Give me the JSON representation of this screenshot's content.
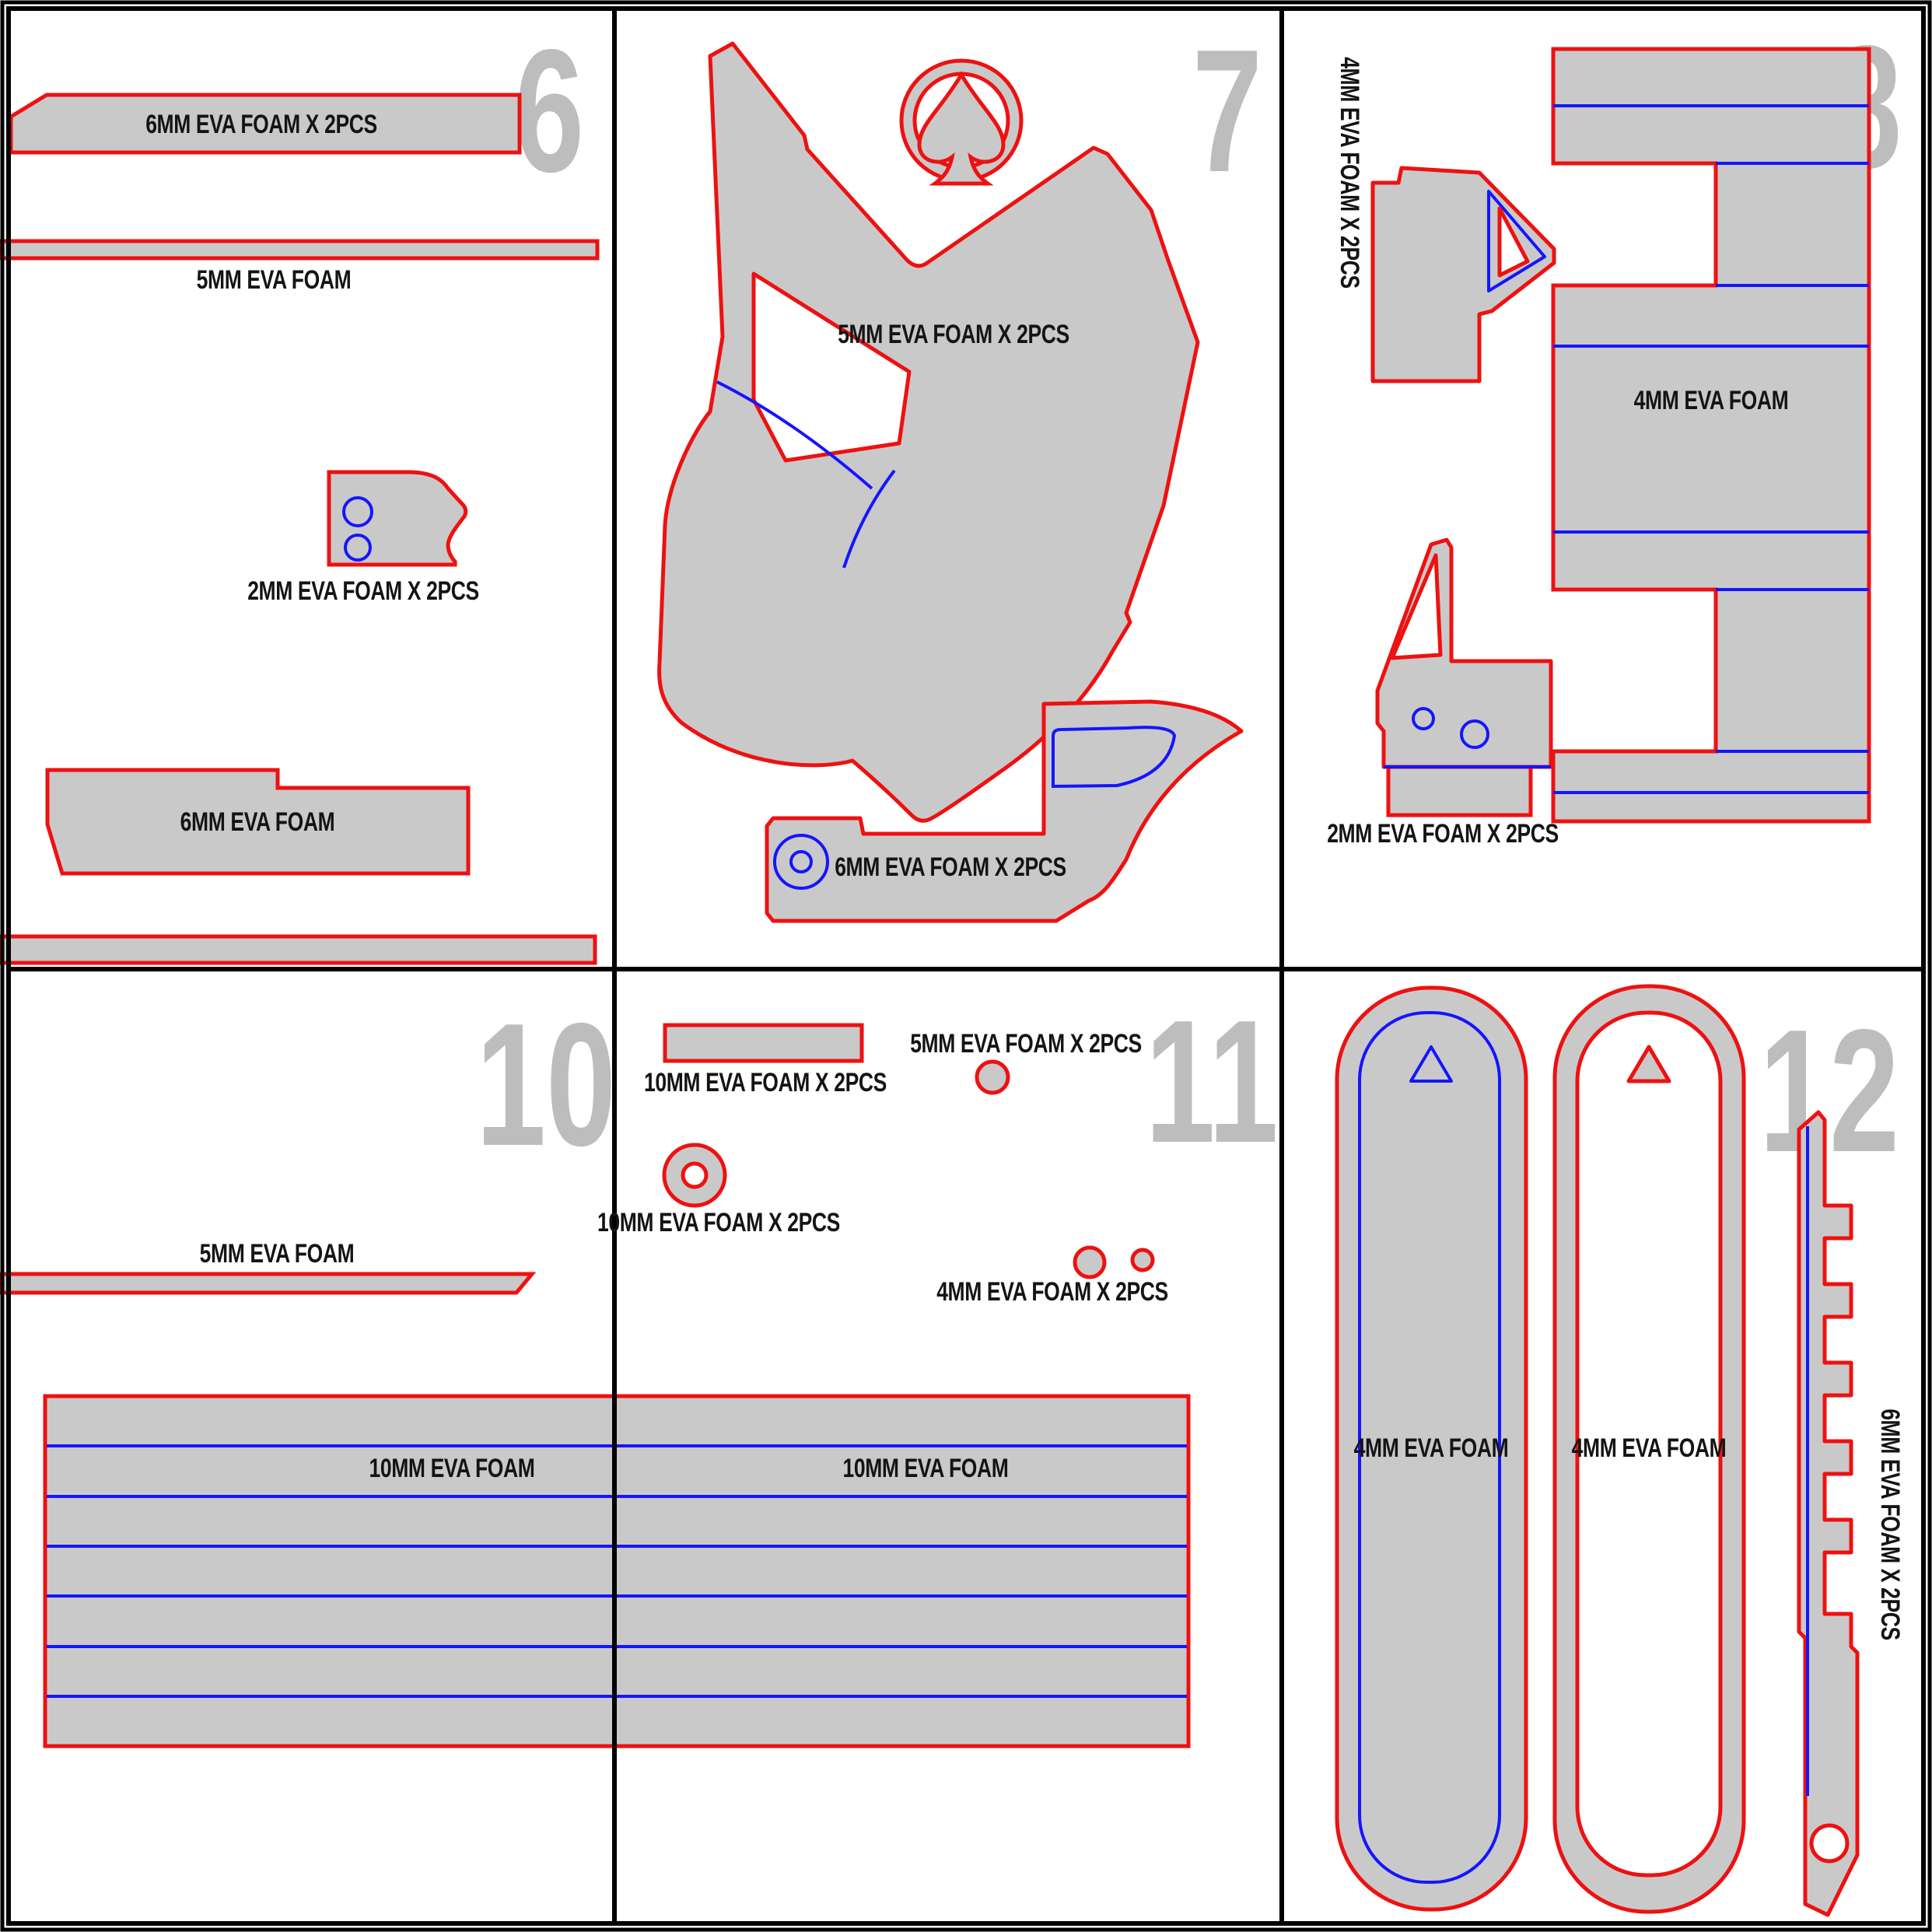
{
  "sheet": {
    "type": "eva-foam-prop-pattern-sheet",
    "colors": {
      "cut_line": "#ee1111",
      "fold_line": "#1515ff",
      "piece_fill": "#c9c9c9",
      "page_number": "#bdbdbd",
      "label_text": "#141414",
      "border": "#000000",
      "background": "#ffffff"
    }
  },
  "panels": [
    {
      "number": "6",
      "labels": [
        "6MM EVA FOAM X 2PCS",
        "5MM EVA FOAM",
        "2MM EVA FOAM X 2PCS",
        "6MM EVA FOAM"
      ]
    },
    {
      "number": "7",
      "labels": [
        "5MM EVA FOAM X 2PCS",
        "6MM EVA FOAM X 2PCS"
      ]
    },
    {
      "number": "8",
      "labels": [
        "4MM EVA FOAM X 2PCS",
        "4MM EVA FOAM",
        "2MM EVA FOAM X 2PCS"
      ]
    },
    {
      "number": "10",
      "labels": [
        "5MM EVA FOAM",
        "10MM EVA FOAM",
        "10MM EVA FOAM"
      ]
    },
    {
      "number": "11",
      "labels": [
        "10MM EVA FOAM X 2PCS",
        "5MM EVA FOAM X 2PCS",
        "10MM EVA FOAM X 2PCS",
        "4MM EVA FOAM X 2PCS"
      ]
    },
    {
      "number": "12",
      "labels": [
        "4MM EVA FOAM",
        "4MM EVA FOAM",
        "6MM EVA FOAM X 2PCS"
      ]
    }
  ]
}
